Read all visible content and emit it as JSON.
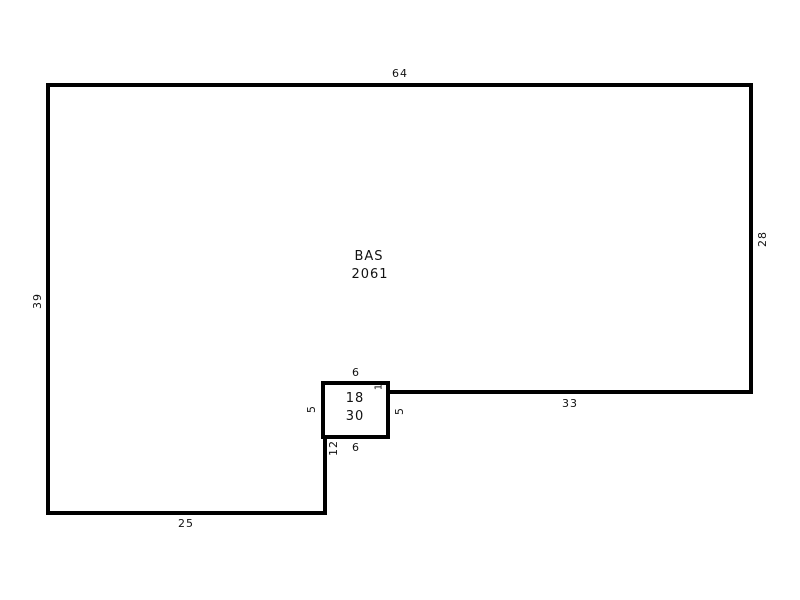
{
  "colors": {
    "background": "#ffffff",
    "line": "#000000",
    "text": "#111111"
  },
  "area": {
    "label": "BAS",
    "square_feet": "2061"
  },
  "inner_box": {
    "line1": "18",
    "line2": "30"
  },
  "dimensions": {
    "top": "64",
    "right": "28",
    "left": "39",
    "mid_wall": "33",
    "bottom": "25",
    "box_top": "6",
    "box_bottom": "6",
    "box_left": "5",
    "box_right": "5",
    "box_offset": "1",
    "notch_below_box": "12"
  }
}
